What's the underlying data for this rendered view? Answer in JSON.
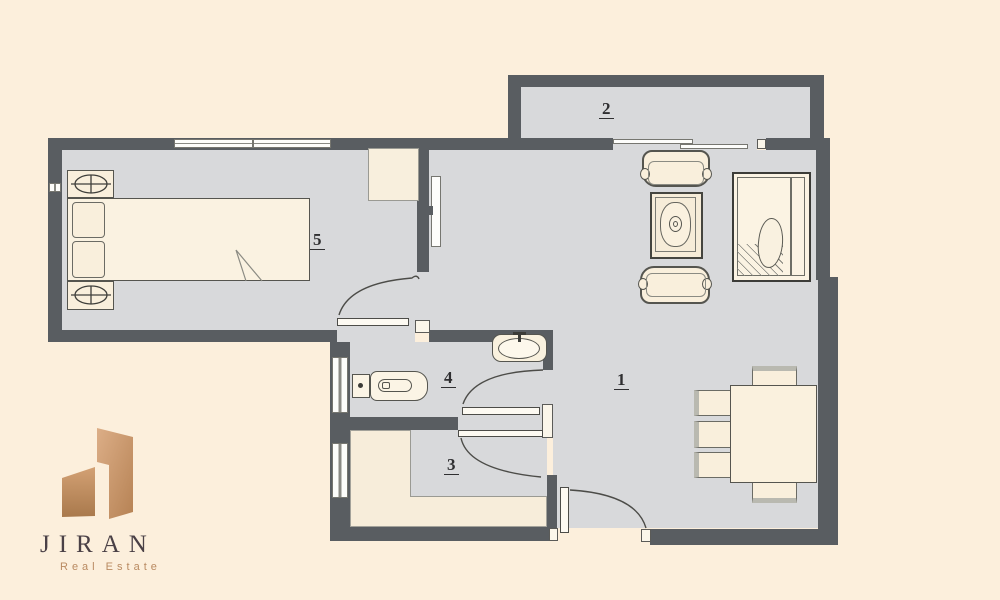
{
  "brand": {
    "name": "JIRAN",
    "tagline": "Real Estate"
  },
  "rooms": [
    {
      "id": "living-room",
      "number": "1"
    },
    {
      "id": "balcony",
      "number": "2"
    },
    {
      "id": "kitchen",
      "number": "3"
    },
    {
      "id": "bathroom",
      "number": "4"
    },
    {
      "id": "bedroom",
      "number": "5"
    }
  ],
  "colors": {
    "background": "#fcefdc",
    "floor": "#d8d9db",
    "wall": "#595d61",
    "furniture": "#f9efdc",
    "logo_copper_light": "#dcae87",
    "logo_copper_dark": "#b07c50",
    "logo_text": "#4a4046",
    "tagline_text": "#b98a61"
  }
}
